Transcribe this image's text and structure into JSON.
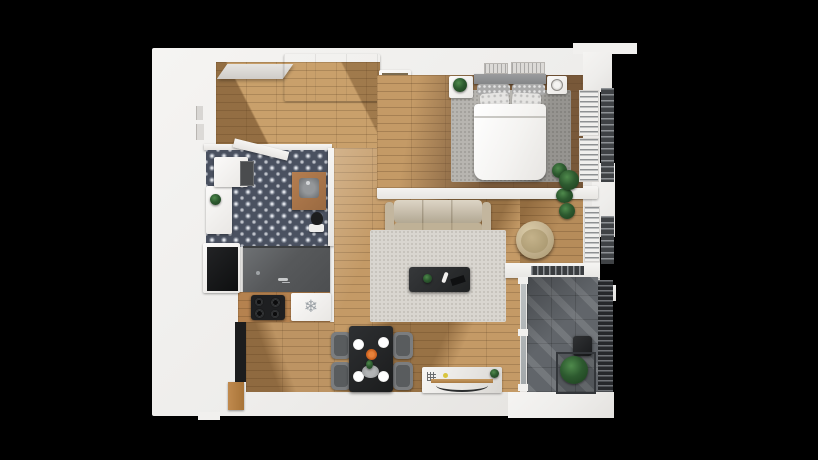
{
  "scene": {
    "title": "3D top-down floor plan render of a one-bedroom apartment",
    "background_color": "#000000",
    "view": "isometric top view"
  },
  "icons": {
    "fridge_snowflake": "❄"
  },
  "colors": {
    "wall_white": "#f1f0ee",
    "wood_light": "#c49a66",
    "wood_shadow": "#6f5136",
    "bathroom_tile": "#4a5160",
    "kitchen_counter": "#57595b",
    "balcony_concrete": "#61656a",
    "rug_living": "#d9d6d0",
    "rug_bedroom": "#b7b5b0",
    "sofa_beige": "#cbbfa7",
    "furniture_black": "#1e1f21",
    "plant_green": "#2d5a2f",
    "accent_orange": "#cf6320"
  },
  "rooms": [
    {
      "id": "entry-hall",
      "floor": "light wood",
      "features": [
        "entry door open",
        "built-in closet",
        "black shoe rack",
        "dresser"
      ]
    },
    {
      "id": "bathroom",
      "floor": "patterned tile",
      "features": [
        "washing machine",
        "cabinet",
        "wood vanity with sink",
        "toilet",
        "open door"
      ]
    },
    {
      "id": "kitchen",
      "floor": "wood",
      "features": [
        "grey counter with sink and faucet",
        "4-burner cooktop",
        "fridge with snowflake symbol",
        "dark storage niche",
        "tall cabinet"
      ]
    },
    {
      "id": "living-dining",
      "floor": "light wood",
      "features": [
        "3-seat beige sofa",
        "speckled rug",
        "dark coffee table",
        "round papasan chair",
        "black dining table with 4 grey chairs and 4 plates",
        "white media console",
        "potted plants"
      ]
    },
    {
      "id": "bedroom",
      "floor": "wood light-to-dark",
      "features": [
        "double bed with white duvet and patterned pillows",
        "grey headboard",
        "two nightstands",
        "plant on nightstand",
        "grey rug",
        "wall air vents",
        "windows with louvers",
        "floor plant"
      ]
    },
    {
      "id": "balcony",
      "floor": "dark concrete tiles",
      "features": [
        "sliding glass door",
        "dark chair",
        "square planter with plant",
        "slat railing"
      ]
    }
  ]
}
